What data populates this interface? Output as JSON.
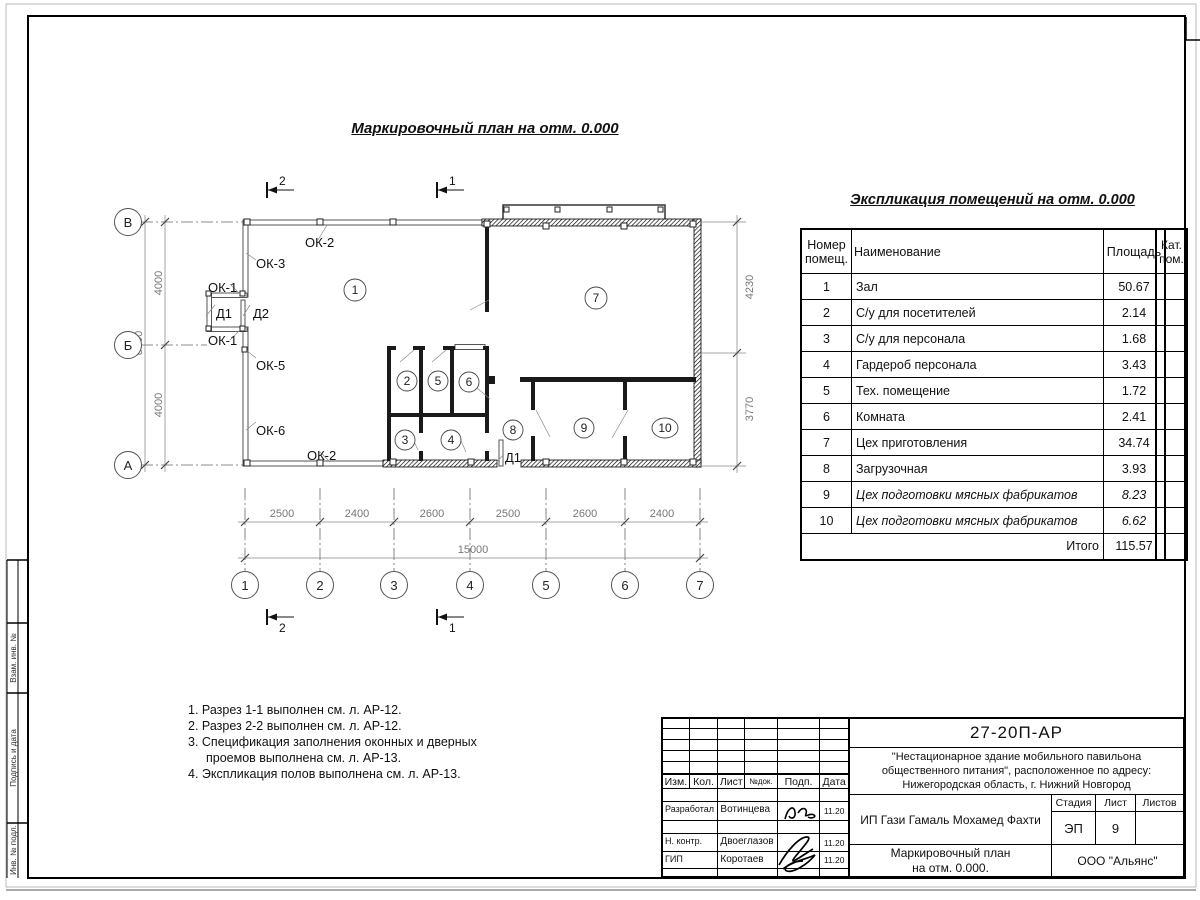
{
  "sheet": {
    "side_stamp": [
      "Взам. инв. №",
      "Подпись и дата",
      "Инв. № подл."
    ]
  },
  "plan": {
    "title": "Маркировочный план на отм. 0.000",
    "axes": {
      "rows": [
        "В",
        "Б",
        "А"
      ],
      "cols": [
        "1",
        "2",
        "3",
        "4",
        "5",
        "6",
        "7"
      ]
    },
    "dims": {
      "col_segments": [
        "2500",
        "2400",
        "2600",
        "2500",
        "2600",
        "2400"
      ],
      "col_total": "15000",
      "row_segments": [
        "4000",
        "4000"
      ],
      "row_total": "8000",
      "right_segments": [
        "4230",
        "3770"
      ]
    },
    "sections": {
      "s1": "1",
      "s2": "2"
    },
    "rooms": [
      "1",
      "2",
      "3",
      "4",
      "5",
      "6",
      "7",
      "8",
      "9",
      "10"
    ],
    "openings": {
      "ok2_top": "ОК-2",
      "ok3": "ОК-3",
      "ok1_top": "ОК-1",
      "d1_vest": "Д1",
      "d2": "Д2",
      "ok1_bot": "ОК-1",
      "ok5": "ОК-5",
      "ok6": "ОК-6",
      "ok2_bot": "ОК-2",
      "d1_back": "Д1"
    }
  },
  "explication": {
    "title": "Экспликация помещений на отм. 0.000",
    "headers": {
      "num": "Номер помещ.",
      "name": "Наименование",
      "area": "Площадь",
      "cat": "Кат. пом."
    },
    "rows": [
      {
        "num": "1",
        "name": "Зал",
        "area": "50.67"
      },
      {
        "num": "2",
        "name": "С/у для посетителей",
        "area": "2.14"
      },
      {
        "num": "3",
        "name": "С/у для персонала",
        "area": "1.68"
      },
      {
        "num": "4",
        "name": "Гардероб персонала",
        "area": "3.43"
      },
      {
        "num": "5",
        "name": "Тех. помещение",
        "area": "1.72"
      },
      {
        "num": "6",
        "name": "Комната",
        "area": "2.41"
      },
      {
        "num": "7",
        "name": "Цех приготовления",
        "area": "34.74"
      },
      {
        "num": "8",
        "name": "Загрузочная",
        "area": "3.93"
      },
      {
        "num": "9",
        "name": "Цех подготовки мясных фабрикатов",
        "area": "8.23"
      },
      {
        "num": "10",
        "name": "Цех подготовки мясных фабрикатов",
        "area": "6.62"
      }
    ],
    "total_label": "Итого",
    "total": "115.57"
  },
  "notes": [
    "1. Разрез 1-1 выполнен см. л. АР-12.",
    "2. Разрез 2-2 выполнен см. л. АР-12.",
    "3. Спецификация заполнения оконных и дверных проемов выполнена см. л. АР-13.",
    "4. Экспликация полов выполнена см. л. АР-13."
  ],
  "title_block": {
    "code": "27-20П-АР",
    "object": "\"Нестационарное здание мобильного павильона общественного питания\", расположенное по адресу: Нижегородская область, г. Нижний Новгород",
    "client": "ИП Гази Гамаль Мохамед Фахти",
    "doc_title_line1": "Маркировочный план",
    "doc_title_line2": "на отм. 0.000.",
    "org": "ООО \"Альянс\"",
    "cols": {
      "izm": "Изм.",
      "kol": "Кол.",
      "list": "Лист",
      "ndok": "№док.",
      "podp": "Подп.",
      "data": "Дата"
    },
    "stage_label": "Стадия",
    "stage": "ЭП",
    "sheet_label": "Лист",
    "sheet_num": "9",
    "sheets_label": "Листов",
    "roles": [
      {
        "role": "Разработал",
        "name": "Вотинцева",
        "date": "11.20"
      },
      {
        "role": "Н. контр.",
        "name": "Двоеглазов",
        "date": "11.20"
      },
      {
        "role": "ГИП",
        "name": "Коротаев",
        "date": "11.20"
      }
    ]
  }
}
